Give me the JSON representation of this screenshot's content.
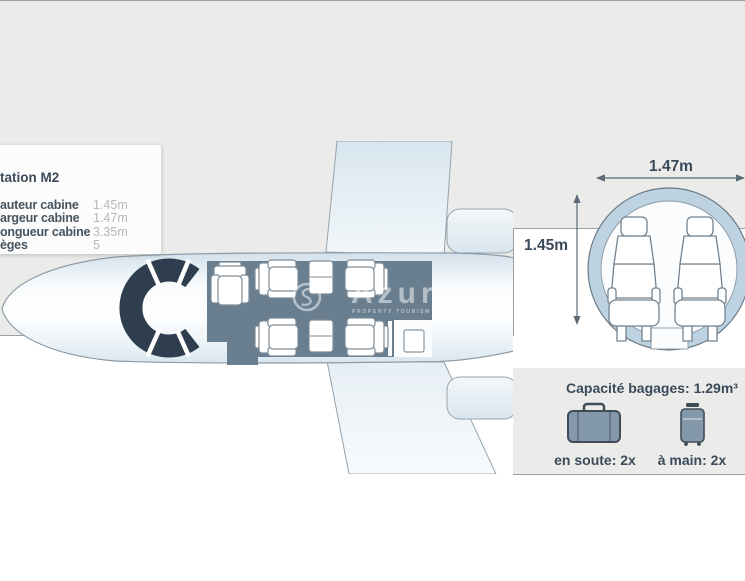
{
  "specs": {
    "title": "tation M2",
    "rows": [
      {
        "label": "auteur cabine",
        "value": "1.45m"
      },
      {
        "label": "argeur cabine",
        "value": "1.47m"
      },
      {
        "label": "ongueur cabine",
        "value": "3.35m"
      },
      {
        "label": "èges",
        "value": "5"
      }
    ]
  },
  "floorplan": {
    "club_seats": 4,
    "side_seats": 1,
    "tables": 2
  },
  "cross_section": {
    "width_label": "1.47m",
    "height_label": "1.45m",
    "seats_abreast": 2
  },
  "baggage": {
    "title": "Capacité bagages: 1.29m³",
    "hold": {
      "icon": "suitcase-icon",
      "label": "en soute: 2x"
    },
    "hand": {
      "icon": "carry-on-icon",
      "label": "à main: 2x"
    }
  },
  "watermark": {
    "text": "Azur",
    "tagline": "PROPERTY TOURISM YACHTING"
  },
  "colors": {
    "panel_bg": "#ebecea",
    "panel_border": "#9aa0a3",
    "cockpit_dark": "#2e3e4f",
    "cabin_floor": "#697f90",
    "fuselage_ring": "#bed3e2",
    "icon_fill": "#8498ab",
    "icon_stroke": "#3f4d59",
    "text_dark": "#3a4a5a",
    "text_muted": "#b3b8bc"
  }
}
